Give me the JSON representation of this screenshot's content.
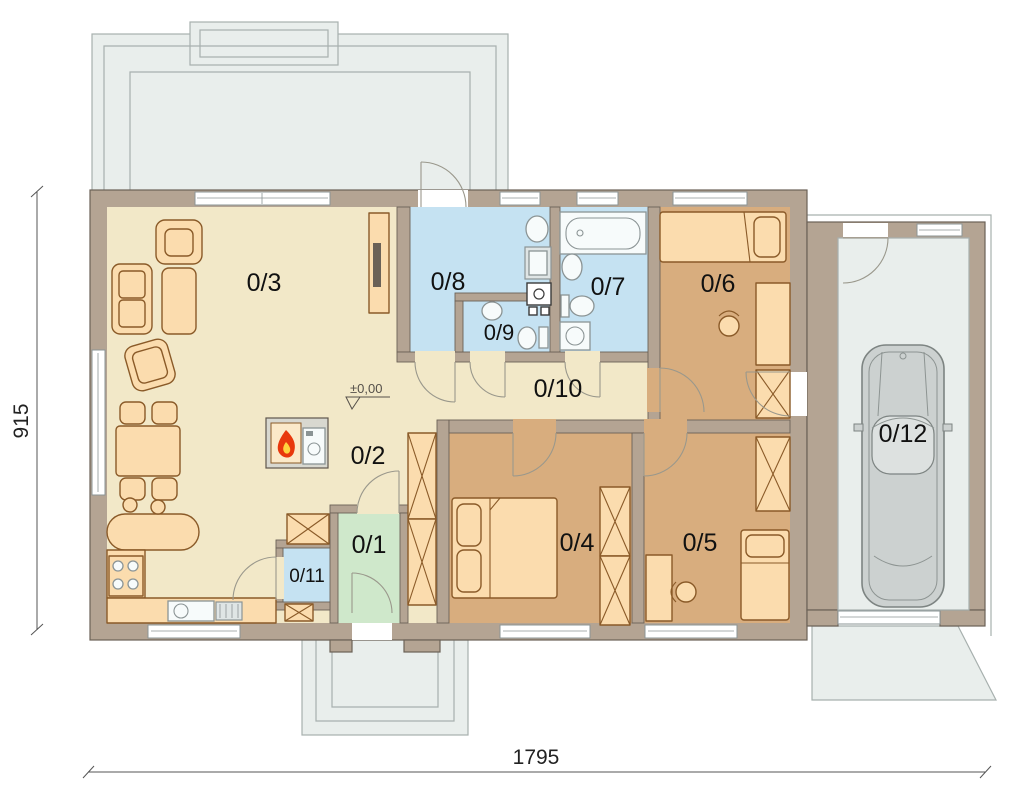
{
  "plan": {
    "type": "floor-plan",
    "rooms": [
      {
        "label": "0/1"
      },
      {
        "label": "0/2"
      },
      {
        "label": "0/3"
      },
      {
        "label": "0/4"
      },
      {
        "label": "0/5"
      },
      {
        "label": "0/6"
      },
      {
        "label": "0/7"
      },
      {
        "label": "0/8"
      },
      {
        "label": "0/9"
      },
      {
        "label": "0/10"
      },
      {
        "label": "0/11"
      },
      {
        "label": "0/12"
      }
    ],
    "level_marker": "±0,00",
    "dimensions": {
      "width": "1795",
      "height": "915"
    },
    "colors": {
      "wall": "#b4a493",
      "floor_living": "#f2e8c8",
      "floor_bath": "#c5e2f2",
      "floor_bedroom": "#d8ad7e",
      "floor_entry": "#cfe8cb",
      "floor_outdoor": "#e9eeec",
      "furniture": "#fbdcae",
      "flame": "#e8380d"
    },
    "icons": {
      "fireplace": "flame-icon",
      "car": "car-icon"
    }
  }
}
